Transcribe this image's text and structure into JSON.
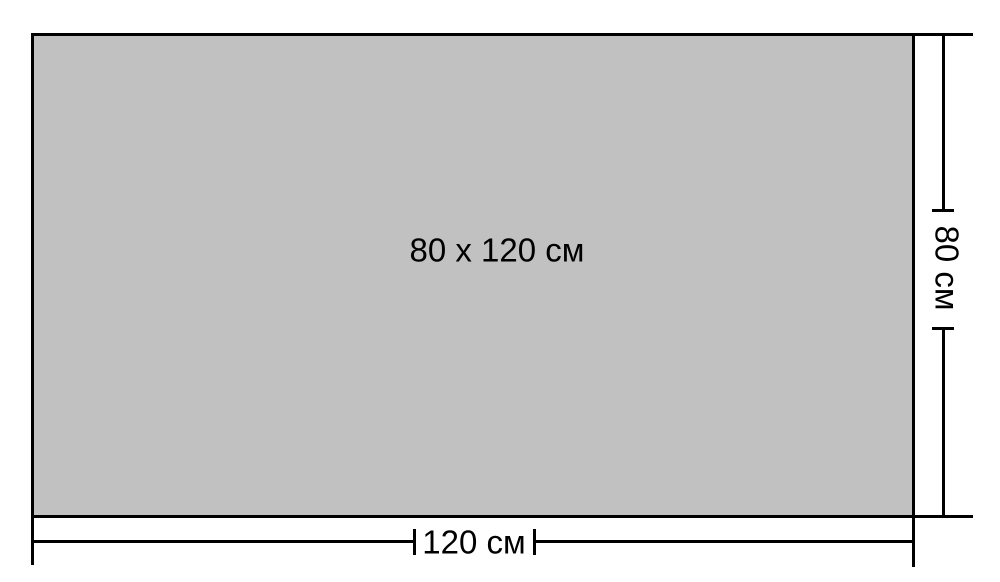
{
  "diagram": {
    "center_label": "80 x 120 см",
    "width_label": "120 см",
    "height_label": "80 см",
    "colors": {
      "fill": "#c1c1c1",
      "line": "#000000",
      "background": "#ffffff"
    }
  }
}
